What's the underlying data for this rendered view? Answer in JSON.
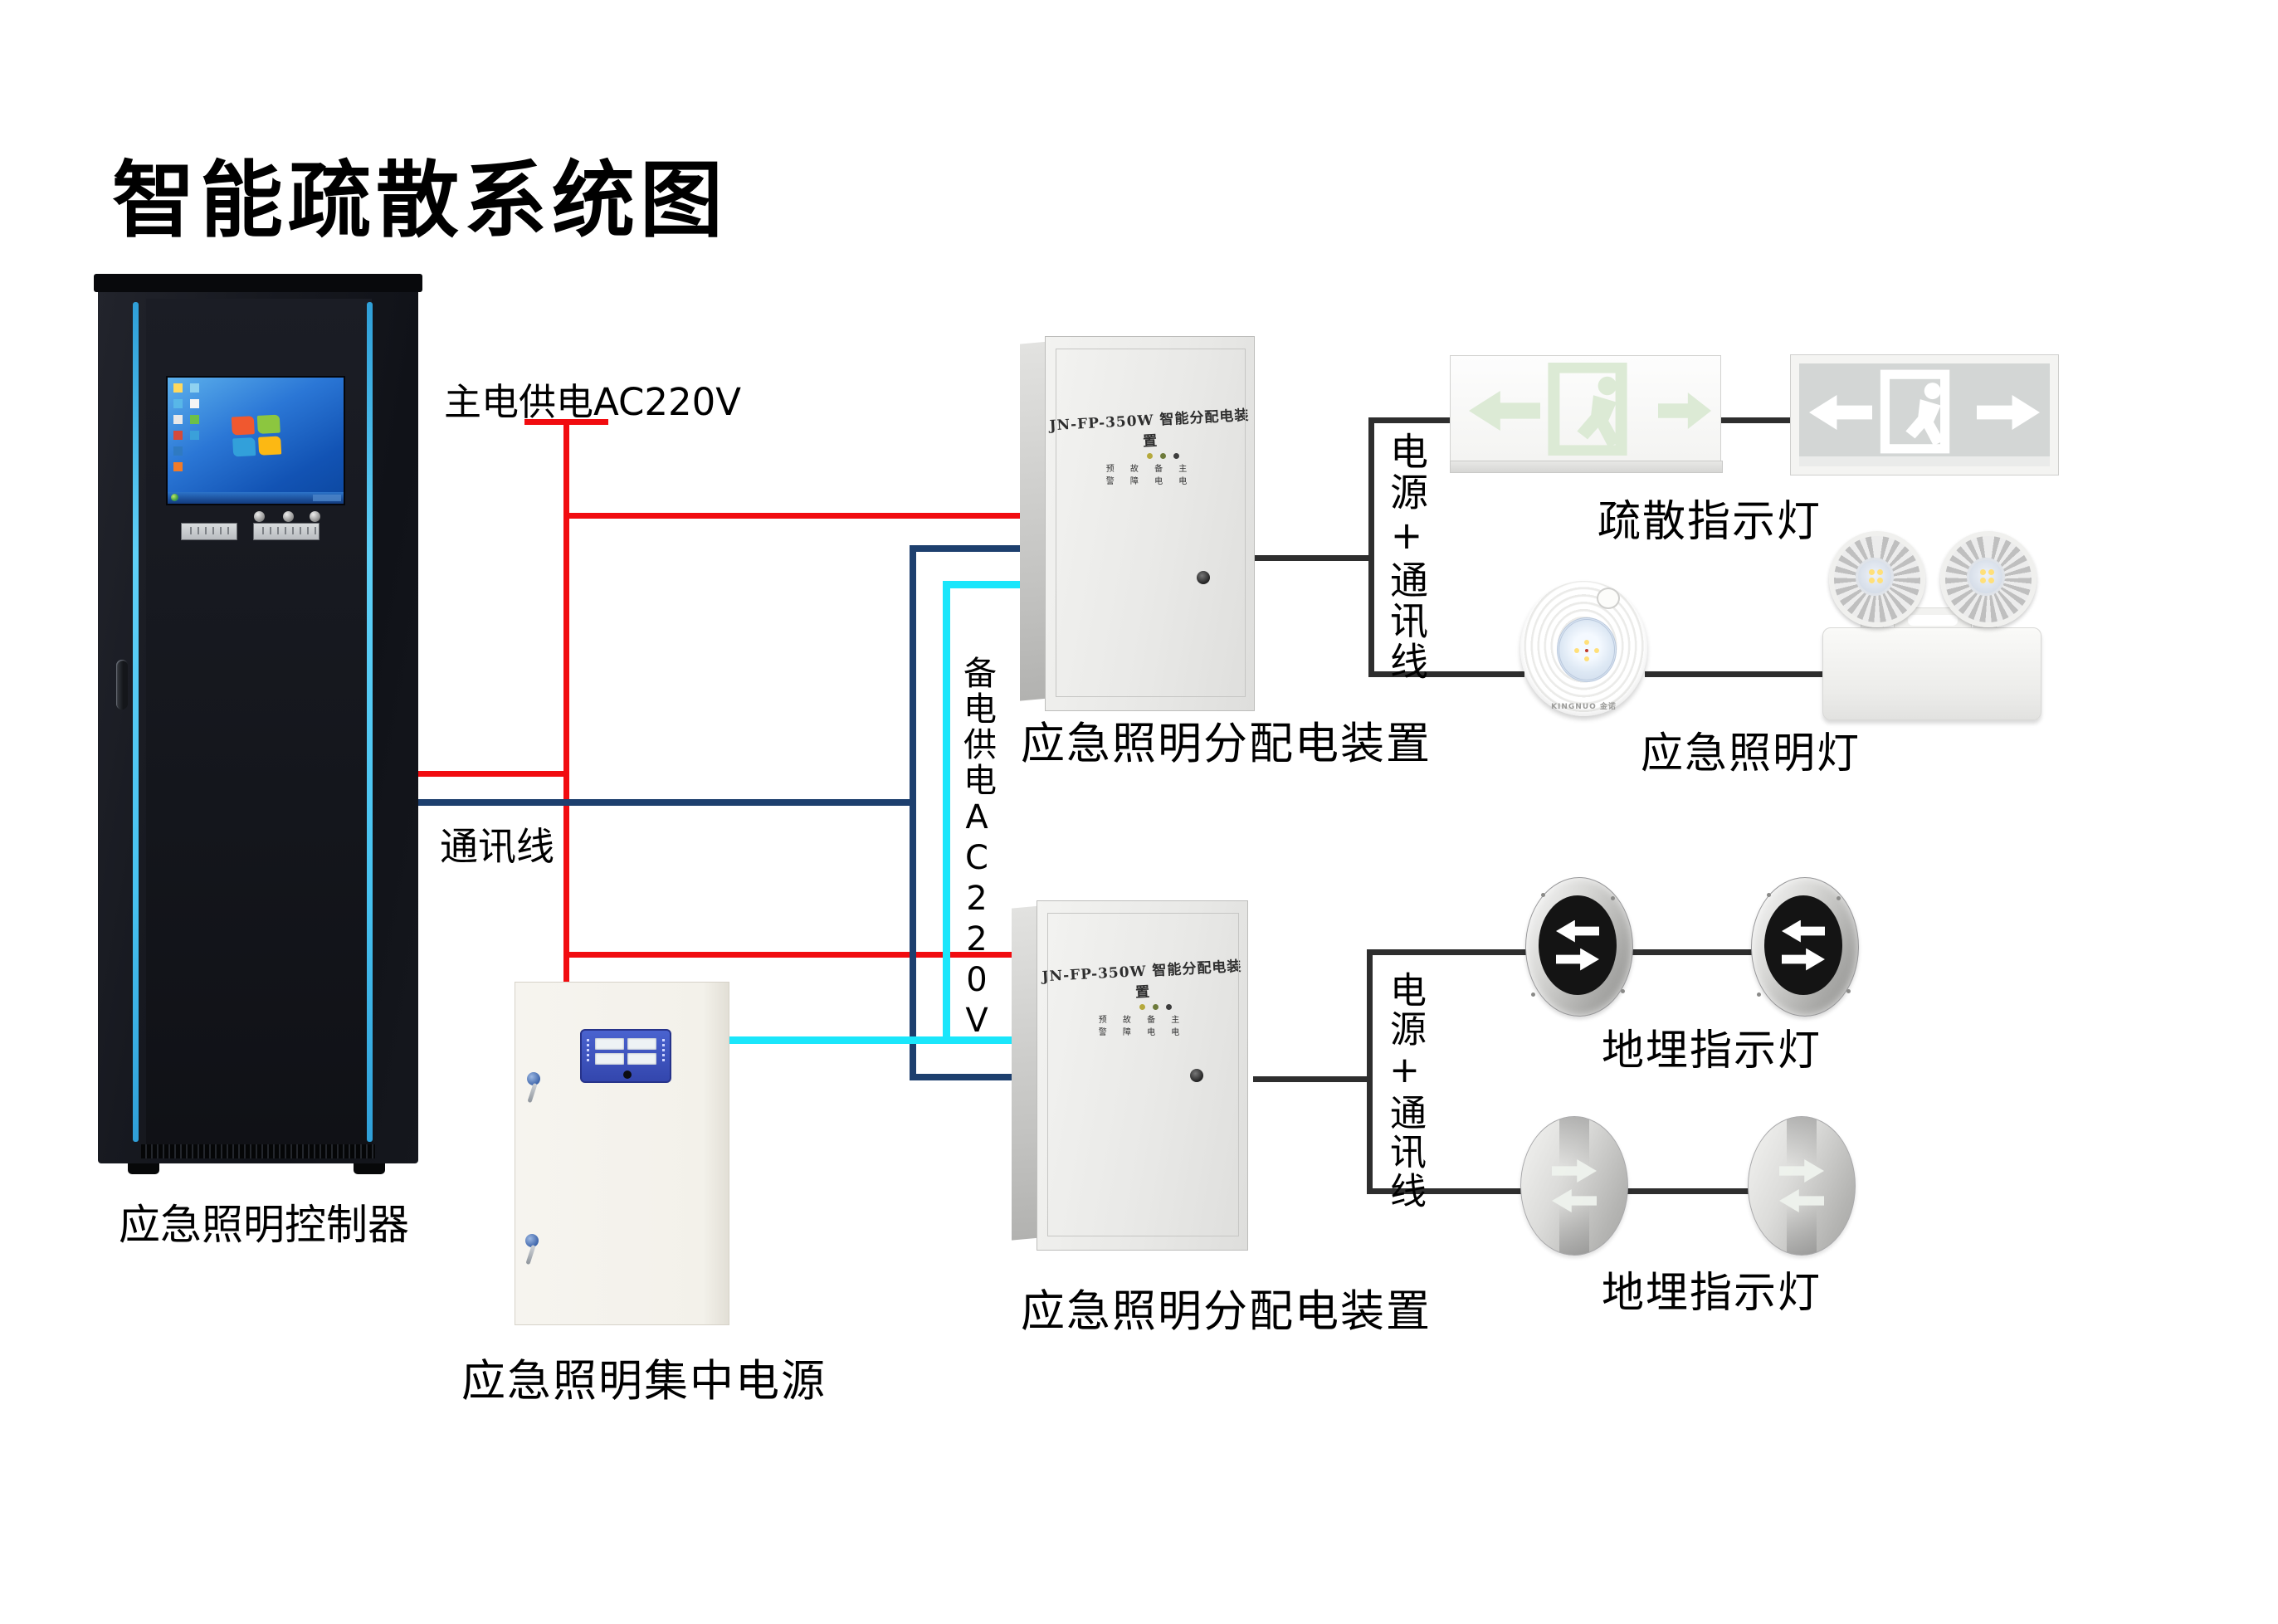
{
  "title": "智能疏散系统图",
  "wire_labels": {
    "main_power": "主电供电AC220V",
    "comm": "通讯线",
    "backup_power": "备电供电AC220V",
    "power_comm": "电源+通讯线"
  },
  "colors": {
    "main_power_wire": "#f10c10",
    "comm_wire": "#1d3f6e",
    "backup_power_wire": "#1ae6fb",
    "device_wire": "#2e2e2e",
    "cabinet_accent": "#47c2f0"
  },
  "devices": {
    "controller": {
      "label": "应急照明控制器"
    },
    "distribution_box_1": {
      "panel_title": "JN-FP-350W 智能分配电装置",
      "indicator_row_1": "预 故 备 主",
      "indicator_row_2": "警 障 电 电",
      "label": "应急照明分配电装置"
    },
    "distribution_box_2": {
      "panel_title": "JN-FP-350W 智能分配电装置",
      "indicator_row_1": "预 故 备 主",
      "indicator_row_2": "警 障 电 电",
      "label": "应急照明分配电装置"
    },
    "central_power": {
      "label": "应急照明集中电源"
    },
    "exit_signs": {
      "label": "疏散指示灯"
    },
    "emergency_lights": {
      "label": "应急照明灯",
      "dome_brand": "KINGNUO 金诺"
    },
    "ground_lights_row1": {
      "label": "地埋指示灯"
    },
    "ground_lights_row2": {
      "label": "地埋指示灯"
    }
  }
}
